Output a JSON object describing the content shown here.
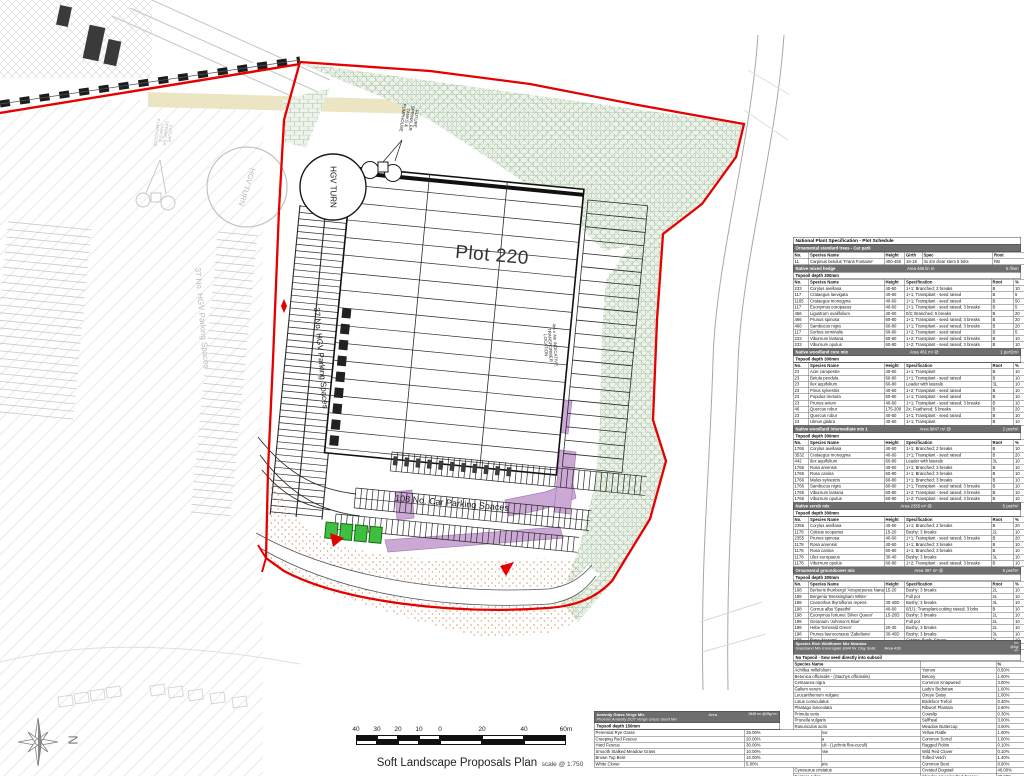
{
  "colors": {
    "boundary_red": "#e60000",
    "hatch_green": "#a9c4a6",
    "bed_purple": "#c79fd1",
    "tree_green": "#3fbf3f",
    "bar_gray": "#6e6e6e",
    "stipple_orange": "#d99a66"
  },
  "plan": {
    "labels": {
      "plot": "Plot 220",
      "hgv_turn": "HGV TURN",
      "hgv_turn_adjacent": "HGV TURN",
      "hgv_parking": "37 No. HGV Parking Spaces",
      "hgv_parking_adjacent": "37 No. HGV Parking Spaces",
      "car_parking": "108 No. Car Parking Spaces",
      "sprinkler": "FUTURE SPRINKLER TANKS & PUMPHOUSE",
      "sprinkler_adjacent": "FUTURE SPRINKLER TANKS & PUMPHOUSE",
      "transformer": "4m x 4m INDICATIVE TRANSFORMER LOCATION",
      "north": "N"
    },
    "title": "Soft Landscape Proposals Plan",
    "title_scale": "scale @ 1:750",
    "scale_ticks": [
      "40",
      "30",
      "20",
      "10",
      "0",
      "20",
      "40",
      "60m"
    ]
  },
  "schedule": {
    "title": "National Plant Specification - Plot Schedule",
    "sections": [
      {
        "bar": "Ornamental standard trees - Car park",
        "bar_mid": "",
        "bar_right": "",
        "topsoil": "",
        "columns": [
          "No.",
          "Species Name",
          "Height",
          "Girth",
          "Spec",
          "Root"
        ],
        "rows": [
          [
            "11",
            "Carpinus betulus 'Frans Fontaine'",
            "400-450",
            "16-18",
            "3x 2m clear stem 5 brks",
            "RB"
          ]
        ]
      },
      {
        "bar": "Native mixed hedge",
        "bar_mid": "Area    466 lin m",
        "bar_right": "5 /linm",
        "topsoil": "Topsoil depth 300mm",
        "columns": [
          "No.",
          "Species Name",
          "Height",
          "Specification",
          "Root",
          "%"
        ],
        "rows": [
          [
            "233",
            "Corylus avellana",
            "40-60",
            "1+1; Branched; 2 breaks",
            "B",
            "10"
          ],
          [
            "117",
            "Crataegus laevigata",
            "40-60",
            "1+1; Transplant - seed raised",
            "B",
            "5"
          ],
          [
            "1165",
            "Crataegus monogyna",
            "40-60",
            "1+1; Transplant - seed raised",
            "B",
            "50"
          ],
          [
            "117",
            "Euonymus europaeus",
            "40-60",
            "1+1; Transplant - seed raised; 3 breaks",
            "B",
            "5"
          ],
          [
            "466",
            "Ligustrum ovalifolium",
            "40-60",
            "0/2; Branched; 5 breaks",
            "B",
            "20"
          ],
          [
            "466",
            "Prunus spinosa",
            "60-80",
            "1+1; Transplant - seed raised; 3 breaks",
            "B",
            "20"
          ],
          [
            "466",
            "Sambucus nigra",
            "60-80",
            "1+1; Transplant - seed raised; 3 breaks",
            "B",
            "20"
          ],
          [
            "117",
            "Sorbus torminalis",
            "60-80",
            "1+2; Transplant - seed raised",
            "B",
            "5"
          ],
          [
            "233",
            "Viburnum lantana",
            "60-80",
            "1+2; Transplant - seed raised; 3 breaks",
            "B",
            "10"
          ],
          [
            "233",
            "Viburnum opulus",
            "60-80",
            "1+2; Transplant - seed raised; 3 breaks",
            "B",
            "10"
          ]
        ]
      },
      {
        "bar": "Native woodland core mix",
        "bar_mid": "Area    461 m² @",
        "bar_right": "1 per/2m²",
        "topsoil": "Topsoil depth 300mm",
        "columns": [
          "No.",
          "Species Name",
          "Height",
          "Specification",
          "Root",
          "%"
        ],
        "rows": [
          [
            "23",
            "Acer campestre",
            "40-60",
            "1+1; Transplant",
            "B",
            "10"
          ],
          [
            "23",
            "Betula pendula",
            "60-80",
            "1+1; Transplant - seed raised",
            "B",
            "10"
          ],
          [
            "23",
            "Ilex aquifolium",
            "60-80",
            "Leader with laterals",
            "3L",
            "10"
          ],
          [
            "23",
            "Pinus sylvestris",
            "40-60",
            "1+2; Transplant - seed raised",
            "B",
            "10"
          ],
          [
            "23",
            "Populus tremula",
            "60-80",
            "1+1; Transplant - seed raised",
            "B",
            "10"
          ],
          [
            "23",
            "Prunus avium",
            "40-60",
            "1+1; Transplant - seed raised; 3 breaks",
            "B",
            "10"
          ],
          [
            "46",
            "Quercus robur",
            "175-200",
            "2x; Feathered; 5 breaks",
            "B",
            "20"
          ],
          [
            "23",
            "Quercus robur",
            "40-60",
            "1+1; Transplant - seed raised",
            "B",
            "10"
          ],
          [
            "23",
            "Ulmus glabra",
            "40-60",
            "1+1; Transplant",
            "B",
            "10"
          ]
        ]
      },
      {
        "bar": "Native woodland intermediate mix 1",
        "bar_mid": "Area    8847 m² @",
        "bar_right": "2 per/m²",
        "topsoil": "Topsoil depth 300mm",
        "columns": [
          "No.",
          "Species Name",
          "Height",
          "Specification",
          "Root",
          "%"
        ],
        "rows": [
          [
            "1766",
            "Corylus avellana",
            "40-60",
            "1+1; Branched; 2 breaks",
            "B",
            "10"
          ],
          [
            "3532",
            "Crataegus monogyna",
            "40-60",
            "1+1; Transplant - seed raised",
            "B",
            "20"
          ],
          [
            "442",
            "Ilex aquifolium",
            "60-80",
            "Leader with laterals",
            "3L",
            "10"
          ],
          [
            "1766",
            "Rosa arvensis",
            "40-60",
            "1+1; Branched; 3 breaks",
            "B",
            "10"
          ],
          [
            "1766",
            "Rosa canina",
            "60-80",
            "1+1; Branched; 3 breaks",
            "B",
            "10"
          ],
          [
            "1766",
            "Malus sylvestris",
            "60-80",
            "1+1; Branched; 3 breaks",
            "B",
            "10"
          ],
          [
            "1766",
            "Sambucus nigra",
            "60-80",
            "1+1; Transplant - seed raised; 3 breaks",
            "B",
            "10"
          ],
          [
            "1766",
            "Viburnum lantana",
            "60-80",
            "1+2; Transplant - seed raised; 3 breaks",
            "B",
            "10"
          ],
          [
            "1766",
            "Viburnum opulus",
            "60-80",
            "1+2; Transplant - seed raised; 3 breaks",
            "B",
            "10"
          ]
        ]
      },
      {
        "bar": "Native scrub mix",
        "bar_mid": "Area    2355 m² @",
        "bar_right": "5 per/m²",
        "topsoil": "Topsoil depth 300mm",
        "columns": [
          "No.",
          "Species Name",
          "Height",
          "Specification",
          "Root",
          "%"
        ],
        "rows": [
          [
            "2355",
            "Corylus avellana",
            "40-60",
            "1+1; Branched; 2 breaks",
            "B",
            "20"
          ],
          [
            "1178",
            "Cytisus scoparius",
            "15-20",
            "Bushy; 3 breaks",
            "2L",
            "10"
          ],
          [
            "2355",
            "Prunus spinosa",
            "40-60",
            "1+1; Transplant - seed raised; 3 breaks",
            "B",
            "20"
          ],
          [
            "1178",
            "Rosa arvensis",
            "40-60",
            "1+1; Branched; 3 breaks",
            "B",
            "10"
          ],
          [
            "1178",
            "Rosa canina",
            "60-80",
            "1+1; Branched; 3 breaks",
            "B",
            "10"
          ],
          [
            "1178",
            "Ulex europaeus",
            "30-40",
            "Bushy; 3 breaks",
            "3L",
            "10"
          ],
          [
            "1178",
            "Viburnum opulus",
            "60-80",
            "1+2; Transplant - seed raised; 3 breaks",
            "B",
            "10"
          ]
        ]
      },
      {
        "bar": "Ornamental groundcover mix",
        "bar_mid": "Area    397 m² @",
        "bar_right": "5 per/m²",
        "topsoil": "Topsoil depth 300mm",
        "columns": [
          "No.",
          "Species Name",
          "Height",
          "Specification",
          "Root",
          "%"
        ],
        "rows": [
          [
            "198",
            "Berberis thunbergii 'Atropurpurea Nana'",
            "15-20",
            "Bushy; 3 breaks",
            "2L",
            "10"
          ],
          [
            "198",
            "Bergenia 'Bressingham White'",
            "",
            "Full pot",
            "2L",
            "10"
          ],
          [
            "198",
            "Ceanothus thyrsiflorus repens",
            "30-40D",
            "Bushy; 3 breaks",
            "3L",
            "10"
          ],
          [
            "198",
            "Cornus alba 'Spaethii'",
            "40-60",
            "0/1/1; Transplant-cutting raised; 3 brks",
            "B",
            "10"
          ],
          [
            "198",
            "Euonymus fortunei 'Silver Queen'",
            "15-20D",
            "Bushy; 3 breaks",
            "2L",
            "10"
          ],
          [
            "198",
            "Geranium 'Johnson's Blue'",
            "",
            "Full pot",
            "2L",
            "10"
          ],
          [
            "198",
            "Hebe 'Emerald Green'",
            "20-30",
            "Bushy; 3 breaks",
            "2L",
            "10"
          ],
          [
            "198",
            "Prunus laurocerasus 'Zabeliana'",
            "30-40D",
            "Bushy; 3 breaks",
            "3L",
            "10"
          ],
          [
            "198",
            "Rosa 'Nozomi'",
            "",
            "Cutting; Bush; Strong",
            "2L",
            "10"
          ],
          [
            "198",
            "Spiraea japonica 'Gold Mound'",
            "30-40",
            "Bushy; 6 breaks",
            "2L",
            "10"
          ]
        ]
      }
    ]
  },
  "wildflower": {
    "title": "Species Rich Wildflower Mix Meadow",
    "subtitle_plain": "Grassland Mix ",
    "subtitle_italic": "Emorsgate EM4 for Clay Soils",
    "area_label": "Area",
    "area_value": "433",
    "unit_lines": [
      "m²",
      "@4g/",
      "m²"
    ],
    "note": "No Topsoil - Sow seed directly into subsoil",
    "header": "Species Name",
    "pct_header": "%",
    "rows": [
      [
        "Achillea millefolium",
        "Yarrow",
        "0.50%"
      ],
      [
        "Betonica officinalis - (Stachys officinalis)",
        "Betony",
        "1.00%"
      ],
      [
        "Centaurea nigra",
        "Common Knapweed",
        "3.00%"
      ],
      [
        "Galium verum",
        "Lady's Bedstraw",
        "1.00%"
      ],
      [
        "Leucanthemum vulgare",
        "Oxeye Daisy",
        "1.00%"
      ],
      [
        "Lotus corniculatus",
        "Birdsfoot Trefoil",
        "0.30%"
      ],
      [
        "Plantago lanceolata",
        "Ribwort Plantain",
        "2.60%"
      ],
      [
        "Primula veris",
        "Cowslip",
        "0.30%"
      ],
      [
        "Prunella vulgaris",
        "Selfheal",
        "3.00%"
      ],
      [
        "Ranunculus acris",
        "Meadow Buttercup",
        "3.00%"
      ],
      [
        "Rhinanthus minor",
        "Yellow Rattle",
        "1.00%"
      ],
      [
        "Rumex acetosa",
        "Common Sorrel",
        "1.00%"
      ],
      [
        "Silene flos-cuculi - (Lychnis flos-cuculi)",
        "Ragged Robin",
        "0.10%"
      ],
      [
        "Trifolium pratense",
        "Wild Red Clover",
        "0.10%"
      ],
      [
        "Vicia cracca",
        "Tufted Vetch",
        "1.40%"
      ],
      [
        "Agrostis capillaris",
        "Common Bent",
        "8.00%"
      ],
      [
        "Cynosurus cristatus",
        "Crested Dogstail",
        "40.00%"
      ],
      [
        "Festuca rubra",
        "Slender-creeping Red Fescue",
        "28.00%"
      ],
      [
        "Phleum bertolonii",
        "Smaller Cat's-tail",
        "4.00%"
      ]
    ]
  },
  "amenity": {
    "title": "Amenity Grass Verge Mix",
    "subtitle": "Phoenix Amenity DOT Verge Grass Seed Mix",
    "area_label": "Area",
    "area_value": "1848 m² @35g/ m²",
    "topsoil": "Topsoil depth 150mm",
    "rows": [
      [
        "Perennial Rye Grass",
        "25.00%"
      ],
      [
        "Creeping Red Fescue",
        "20.00%"
      ],
      [
        "Hard Fescue",
        "30.00%"
      ],
      [
        "Smooth Stalked Meadow Grass",
        "10.00%"
      ],
      [
        "Brown Top Bent",
        "10.00%"
      ],
      [
        "White Clover",
        "5.00%"
      ]
    ]
  }
}
